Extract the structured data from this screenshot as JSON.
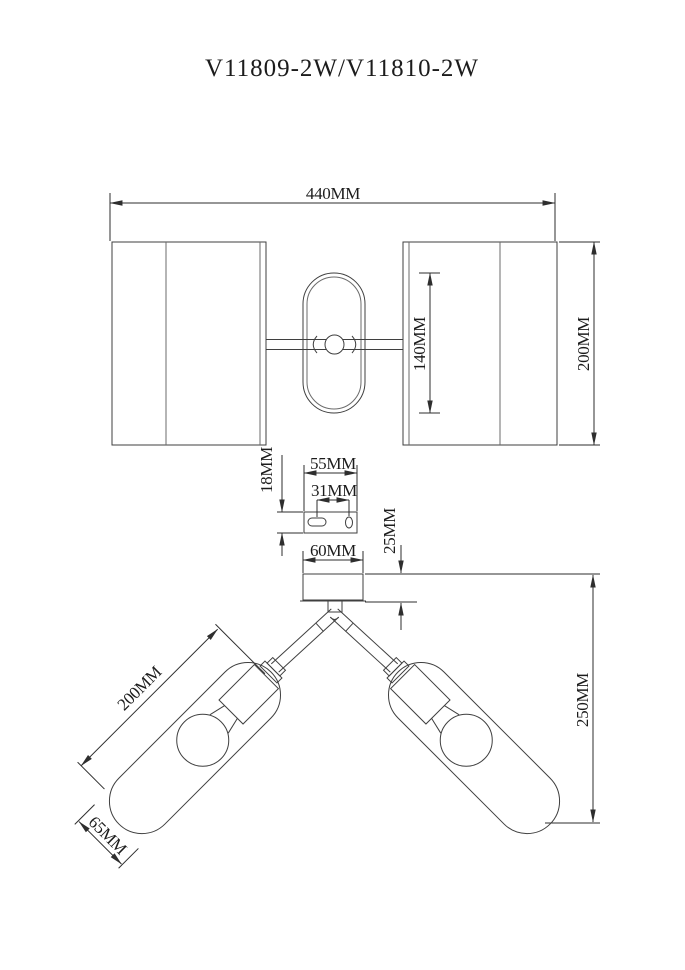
{
  "title": "V11809-2W/V11810-2W",
  "drawing": {
    "type": "technical-dimension-drawing",
    "product": "two-arm wall/ceiling lamp",
    "views": {
      "front_view": {
        "overall_width": "440MM",
        "shade_height": "200MM",
        "backplate_height": "140MM"
      },
      "mounting_bracket": {
        "width": "55MM",
        "hole_spacing": "31MM",
        "height": "18MM"
      },
      "bottom_view": {
        "canopy_width": "60MM",
        "canopy_height": "25MM",
        "overall_drop": "250MM",
        "shade_length": "200MM",
        "shade_diameter": "65MM"
      }
    }
  }
}
